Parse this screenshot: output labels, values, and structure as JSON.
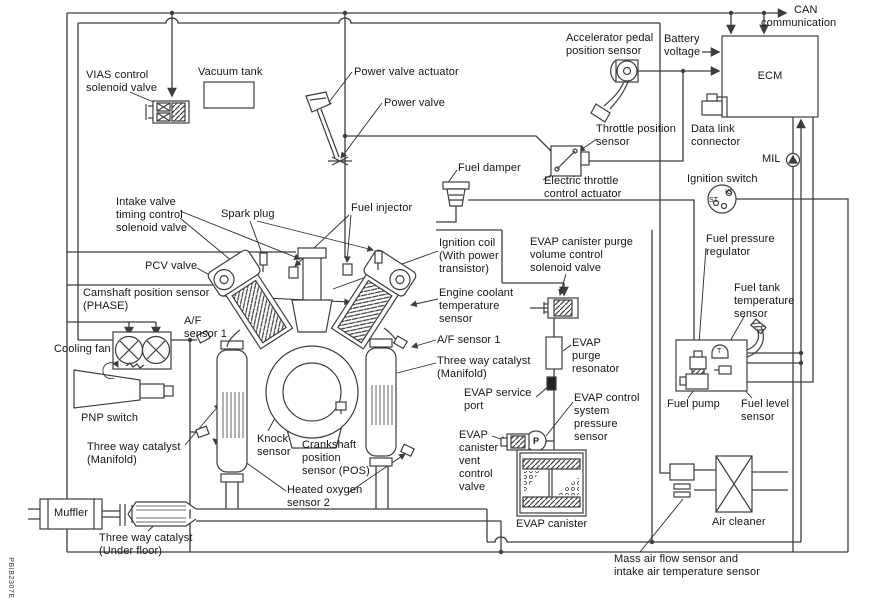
{
  "diagram": {
    "description": "Engine control system component location diagram",
    "line_color": "#3d3d3d",
    "background": "#ffffff",
    "figure_code": "PBIB2307E"
  },
  "labels": {
    "vias": "VIAS control\nsolenoid valve",
    "vacuum_tank": "Vacuum tank",
    "power_valve_actuator": "Power valve actuator",
    "power_valve": "Power valve",
    "accelerator_pedal": "Accelerator pedal\nposition sensor",
    "battery_voltage": "Battery\nvoltage",
    "can_communication": "CAN\ncommunication",
    "ecm": "ECM",
    "data_link_connector": "Data link\nconnector",
    "mil": "MIL",
    "ignition_switch": "Ignition switch",
    "ig": "IG",
    "st": "ST",
    "throttle_position": "Throttle position\nsensor",
    "electric_throttle": "Electric throttle\ncontrol actuator",
    "fuel_damper": "Fuel damper",
    "intake_valve_timing": "Intake valve\ntiming control\nsolenoid valve",
    "spark_plug": "Spark plug",
    "fuel_injector": "Fuel injector",
    "pcv_valve": "PCV valve",
    "camshaft_position": "Camshaft position sensor\n(PHASE)",
    "ignition_coil": "Ignition coil\n(With power\ntransistor)",
    "engine_coolant": "Engine coolant\ntemperature\nsensor",
    "evap_purge_volume": "EVAP canister purge\nvolume control\nsolenoid valve",
    "af_sensor_left": "A/F\nsensor 1",
    "af_sensor_right": "A/F sensor 1",
    "cooling_fan": "Cooling fan",
    "three_way_manifold_right": "Three way catalyst\n(Manifold)",
    "evap_purge_resonator": "EVAP\npurge\nresonator",
    "fuel_pressure_regulator": "Fuel pressure\nregulator",
    "fuel_tank_temperature": "Fuel tank\ntemperature\nsensor",
    "tank_t": "T",
    "pnp_switch": "PNP switch",
    "evap_service_port": "EVAP service\nport",
    "three_way_manifold_left": "Three way catalyst\n(Manifold)",
    "knock_sensor": "Knock\nsensor",
    "crankshaft_position": "Crankshaft\nposition\nsensor (POS)",
    "heated_oxygen": "Heated oxygen\nsensor 2",
    "evap_control_pressure": "EVAP control\nsystem\npressure\nsensor",
    "pressure_p": "P",
    "evap_vent_valve": "EVAP\ncanister\nvent\ncontrol\nvalve",
    "evap_canister": "EVAP canister",
    "fuel_pump": "Fuel pump",
    "fuel_level_sensor": "Fuel level\nsensor",
    "muffler": "Muffler",
    "three_way_under_floor": "Three way catalyst\n(Under floor)",
    "air_cleaner": "Air cleaner",
    "mass_air_flow": "Mass air flow sensor and\nintake air temperature sensor",
    "figure_code": "PBIB2307E"
  }
}
